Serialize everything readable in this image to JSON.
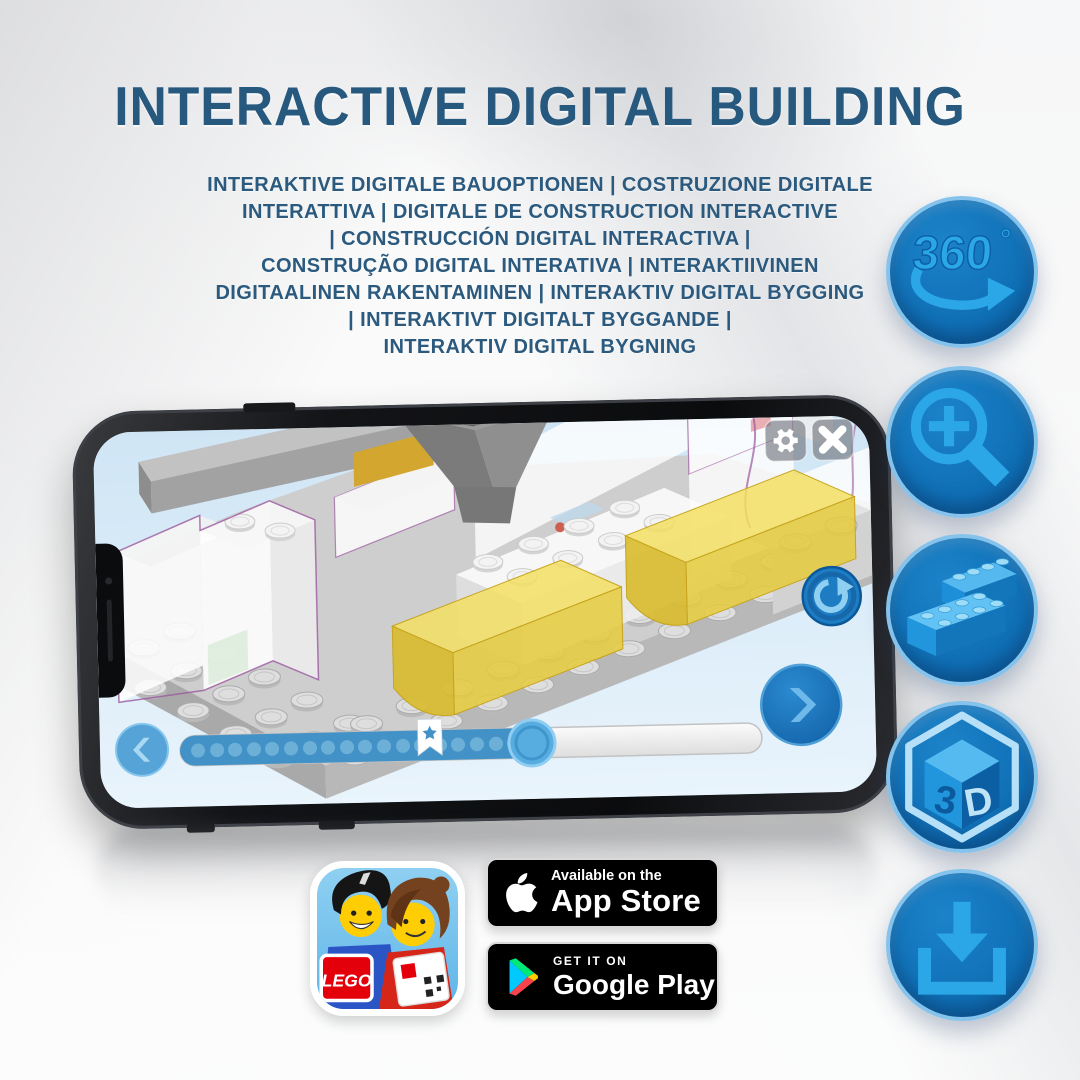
{
  "title": "INTERACTIVE DIGITAL BUILDING",
  "subtitle": {
    "lines": [
      "INTERAKTIVE DIGITALE BAUOPTIONEN | COSTRUZIONE DIGITALE",
      "INTERATTIVA | DIGITALE DE CONSTRUCTION INTERACTIVE",
      "| CONSTRUCCIÓN DIGITAL INTERACTIVA |",
      "CONSTRUÇÃO DIGITAL INTERATIVA | INTERAKTIIVINEN",
      "DIGITAALINEN RAKENTAMINEN | INTERAKTIV DIGITAL BYGGING",
      "| INTERAKTIVT DIGITALT BYGGANDE |",
      "INTERAKTIV DIGITAL BYGNING"
    ]
  },
  "features": {
    "rotate360": {
      "value": "360",
      "degree": "°"
    },
    "cube3d": {
      "left": "3",
      "right": "D"
    }
  },
  "badges": {
    "lego_app": {
      "logo_text": "LEGO"
    },
    "app_store": {
      "line1": "Available on the",
      "line2": "App Store"
    },
    "google_play": {
      "line1": "GET IT ON",
      "line2": "Google Play"
    }
  },
  "colors": {
    "heading_blue": "#27587E",
    "circle_fill": "#1173BA",
    "circle_rim": "#85C3EC",
    "glyph_blue": "#2BA6E6"
  }
}
